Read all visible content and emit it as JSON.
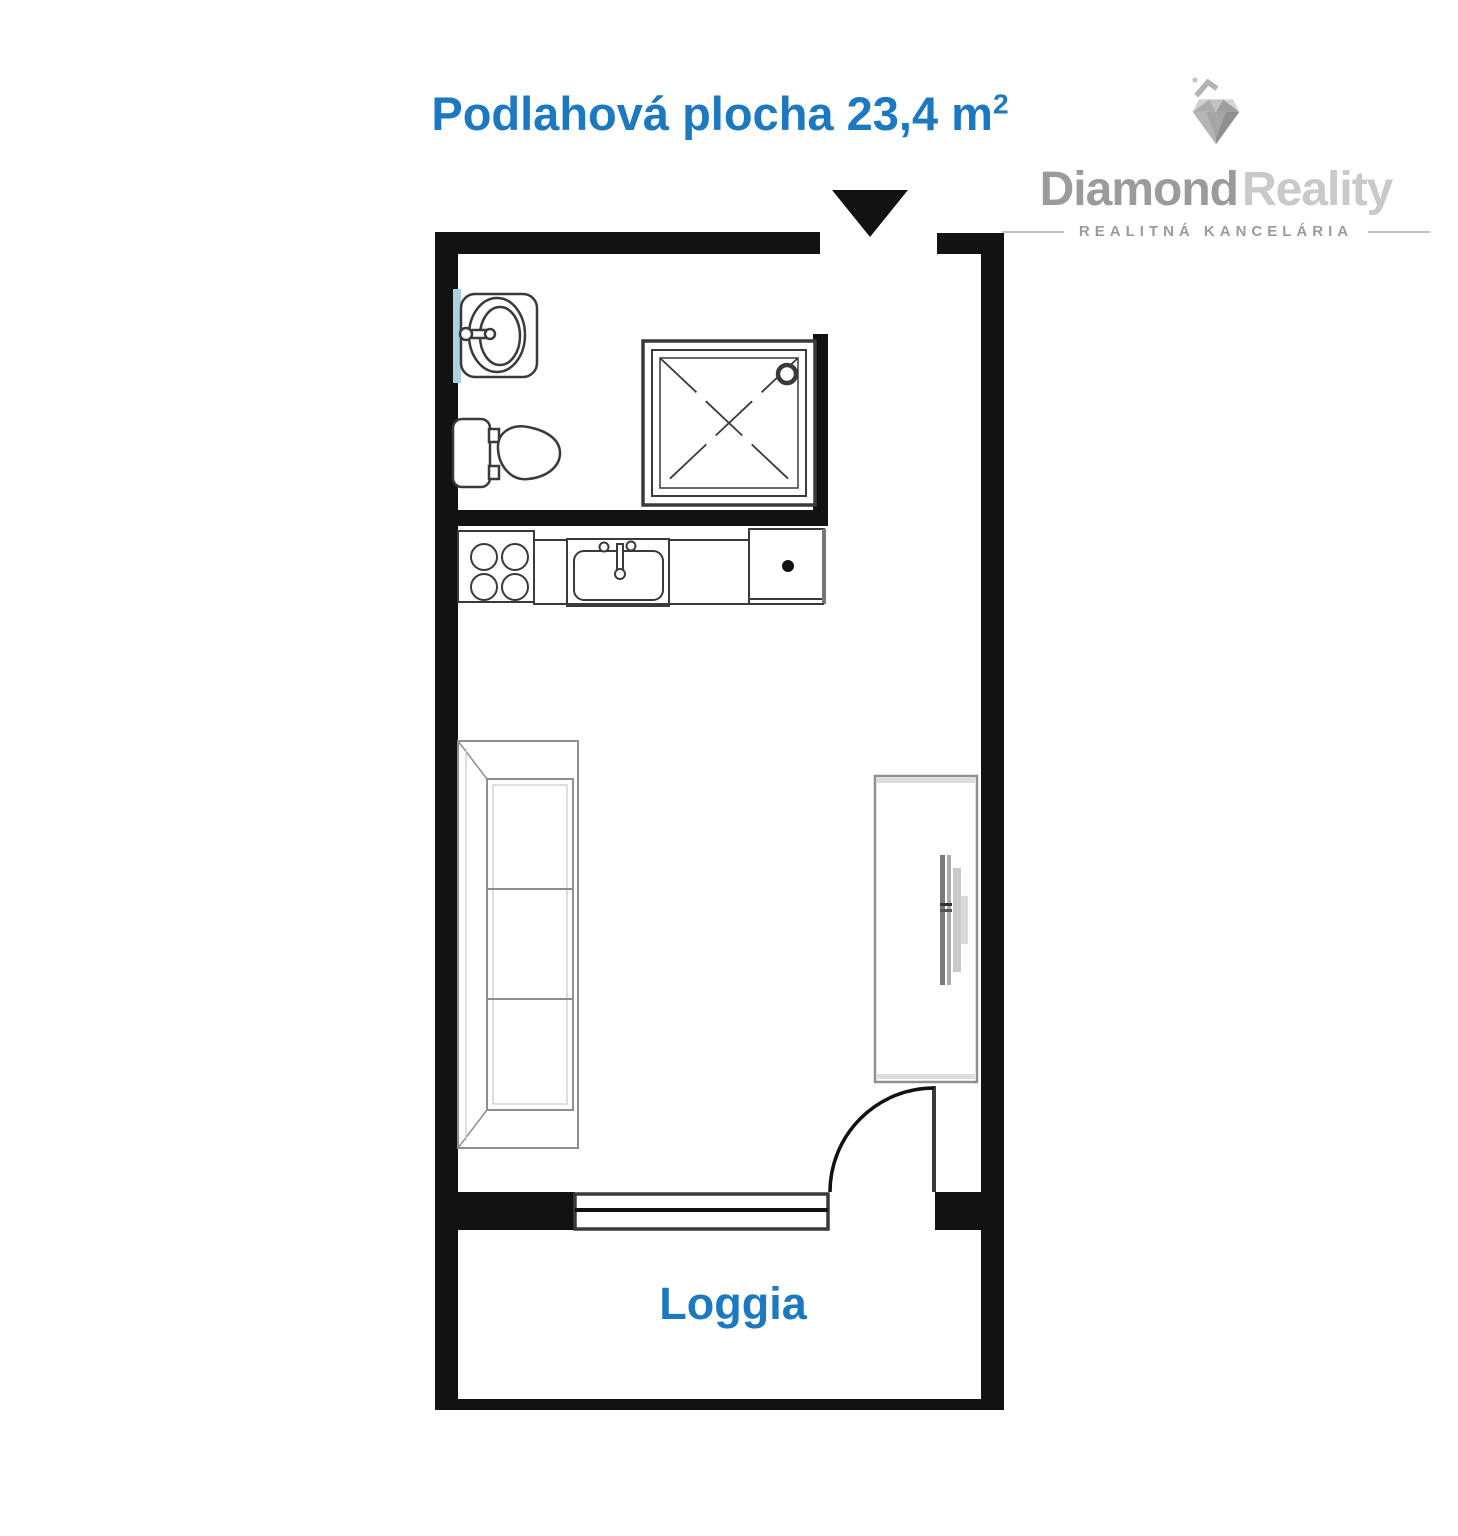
{
  "header": {
    "title": "Podlahová plocha 23,4 m",
    "title_superscript": "2"
  },
  "logo": {
    "brand_primary": "Diamond",
    "brand_secondary": "Reality",
    "tagline": "REALITNÁ KANCELÁRIA",
    "icon": "diamond-house-icon"
  },
  "plan": {
    "loggia_label": "Loggia",
    "fixtures": [
      "entrance-arrow",
      "washbasin",
      "toilet",
      "shower",
      "stove",
      "countertop",
      "kitchen-sink",
      "appliance",
      "sofa",
      "wardrobe",
      "tv",
      "balcony-door",
      "balcony-window",
      "loggia"
    ]
  },
  "colors": {
    "accent": "#1b78c1",
    "wall": "#121212",
    "fixture-line": "#3a3a3a",
    "furniture-line": "#8f8f8f",
    "tile-blue": "#a9d2dd",
    "logo-dark": "#9b9b9b",
    "logo-light": "#c9c9c9",
    "logo-line": "#c4c4c4"
  }
}
